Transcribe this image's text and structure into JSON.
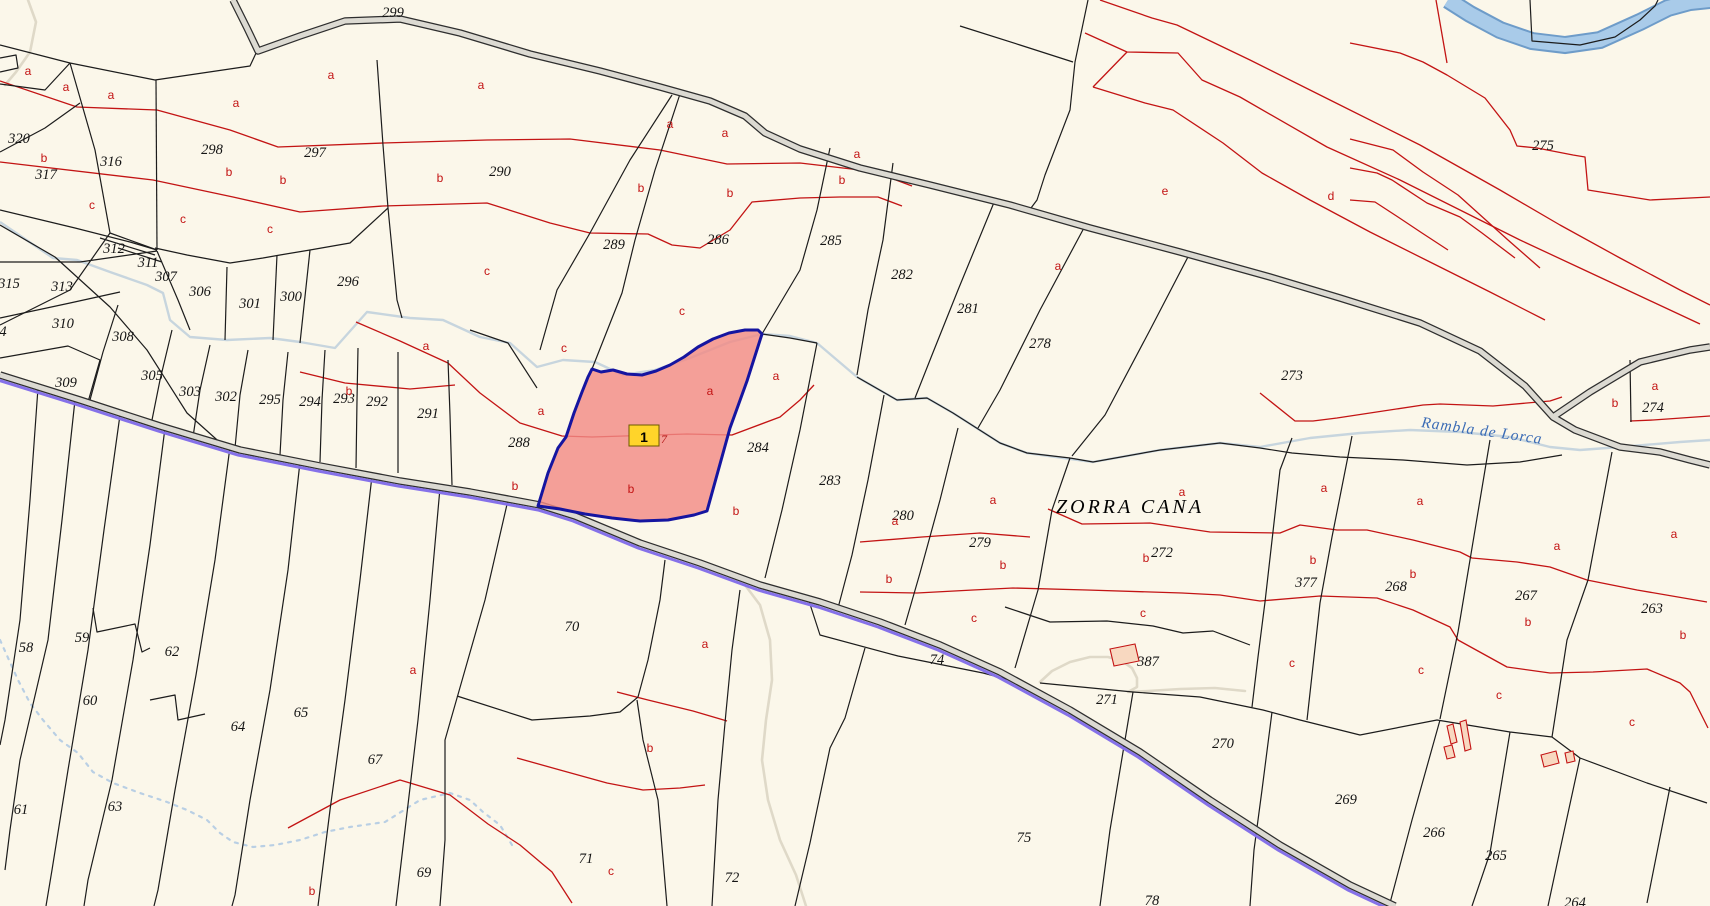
{
  "map": {
    "title": "cadastral-parcel-map",
    "place_names": [
      {
        "text": "ZORRA CANA",
        "x": 1130,
        "y": 507
      }
    ],
    "water_labels": [
      {
        "text": "Rambla de Lorca",
        "x": 1482,
        "y": 431,
        "angle": 8
      }
    ],
    "highlight": {
      "marker_label": "1",
      "sub_label": "7",
      "x": 644,
      "y": 436
    },
    "parcel_numbers": [
      {
        "n": "299",
        "x": 393,
        "y": 13
      },
      {
        "n": "320",
        "x": 19,
        "y": 139
      },
      {
        "n": "317",
        "x": 46,
        "y": 175
      },
      {
        "n": "316",
        "x": 111,
        "y": 162
      },
      {
        "n": "298",
        "x": 212,
        "y": 150
      },
      {
        "n": "297",
        "x": 315,
        "y": 153
      },
      {
        "n": "290",
        "x": 500,
        "y": 172
      },
      {
        "n": "289",
        "x": 614,
        "y": 245
      },
      {
        "n": "286",
        "x": 718,
        "y": 240
      },
      {
        "n": "285",
        "x": 831,
        "y": 241
      },
      {
        "n": "282",
        "x": 902,
        "y": 275
      },
      {
        "n": "281",
        "x": 968,
        "y": 309
      },
      {
        "n": "278",
        "x": 1040,
        "y": 344
      },
      {
        "n": "275",
        "x": 1543,
        "y": 146
      },
      {
        "n": "273",
        "x": 1292,
        "y": 376
      },
      {
        "n": "274",
        "x": 1653,
        "y": 408
      },
      {
        "n": "312",
        "x": 114,
        "y": 249
      },
      {
        "n": "311",
        "x": 148,
        "y": 263
      },
      {
        "n": "307",
        "x": 166,
        "y": 277
      },
      {
        "n": "315",
        "x": 9,
        "y": 284
      },
      {
        "n": "313",
        "x": 62,
        "y": 287
      },
      {
        "n": "306",
        "x": 200,
        "y": 292
      },
      {
        "n": "301",
        "x": 250,
        "y": 304
      },
      {
        "n": "300",
        "x": 291,
        "y": 297
      },
      {
        "n": "296",
        "x": 348,
        "y": 282
      },
      {
        "n": "310",
        "x": 63,
        "y": 324
      },
      {
        "n": "4",
        "x": 3,
        "y": 332
      },
      {
        "n": "308",
        "x": 123,
        "y": 337
      },
      {
        "n": "305",
        "x": 152,
        "y": 376
      },
      {
        "n": "309",
        "x": 66,
        "y": 383
      },
      {
        "n": "303",
        "x": 190,
        "y": 392
      },
      {
        "n": "302",
        "x": 226,
        "y": 397
      },
      {
        "n": "295",
        "x": 270,
        "y": 400
      },
      {
        "n": "294",
        "x": 310,
        "y": 402
      },
      {
        "n": "293",
        "x": 344,
        "y": 399
      },
      {
        "n": "292",
        "x": 377,
        "y": 402
      },
      {
        "n": "291",
        "x": 428,
        "y": 414
      },
      {
        "n": "288",
        "x": 519,
        "y": 443
      },
      {
        "n": "284",
        "x": 758,
        "y": 448
      },
      {
        "n": "283",
        "x": 830,
        "y": 481
      },
      {
        "n": "280",
        "x": 903,
        "y": 516
      },
      {
        "n": "279",
        "x": 980,
        "y": 543
      },
      {
        "n": "272",
        "x": 1162,
        "y": 553
      },
      {
        "n": "377",
        "x": 1306,
        "y": 583
      },
      {
        "n": "268",
        "x": 1396,
        "y": 587
      },
      {
        "n": "267",
        "x": 1526,
        "y": 596
      },
      {
        "n": "263",
        "x": 1652,
        "y": 609
      },
      {
        "n": "387",
        "x": 1148,
        "y": 662
      },
      {
        "n": "74",
        "x": 937,
        "y": 660
      },
      {
        "n": "271",
        "x": 1107,
        "y": 700
      },
      {
        "n": "270",
        "x": 1223,
        "y": 744
      },
      {
        "n": "269",
        "x": 1346,
        "y": 800
      },
      {
        "n": "266",
        "x": 1434,
        "y": 833
      },
      {
        "n": "265",
        "x": 1496,
        "y": 856
      },
      {
        "n": "264",
        "x": 1575,
        "y": 903
      },
      {
        "n": "58",
        "x": 26,
        "y": 648
      },
      {
        "n": "59",
        "x": 82,
        "y": 638
      },
      {
        "n": "62",
        "x": 172,
        "y": 652
      },
      {
        "n": "60",
        "x": 90,
        "y": 701
      },
      {
        "n": "61",
        "x": 21,
        "y": 810
      },
      {
        "n": "63",
        "x": 115,
        "y": 807
      },
      {
        "n": "64",
        "x": 238,
        "y": 727
      },
      {
        "n": "65",
        "x": 301,
        "y": 713
      },
      {
        "n": "67",
        "x": 375,
        "y": 760
      },
      {
        "n": "69",
        "x": 424,
        "y": 873
      },
      {
        "n": "70",
        "x": 572,
        "y": 627
      },
      {
        "n": "71",
        "x": 586,
        "y": 859
      },
      {
        "n": "72",
        "x": 732,
        "y": 878
      },
      {
        "n": "75",
        "x": 1024,
        "y": 838
      },
      {
        "n": "78",
        "x": 1152,
        "y": 901
      }
    ],
    "subparcel_letters": [
      {
        "t": "a",
        "x": 28,
        "y": 71
      },
      {
        "t": "a",
        "x": 66,
        "y": 87
      },
      {
        "t": "a",
        "x": 111,
        "y": 95
      },
      {
        "t": "a",
        "x": 236,
        "y": 103
      },
      {
        "t": "a",
        "x": 331,
        "y": 75
      },
      {
        "t": "a",
        "x": 481,
        "y": 85
      },
      {
        "t": "a",
        "x": 670,
        "y": 124
      },
      {
        "t": "a",
        "x": 725,
        "y": 133
      },
      {
        "t": "a",
        "x": 857,
        "y": 154
      },
      {
        "t": "b",
        "x": 44,
        "y": 158
      },
      {
        "t": "b",
        "x": 229,
        "y": 172
      },
      {
        "t": "b",
        "x": 283,
        "y": 180
      },
      {
        "t": "b",
        "x": 440,
        "y": 178
      },
      {
        "t": "b",
        "x": 641,
        "y": 188
      },
      {
        "t": "b",
        "x": 730,
        "y": 193
      },
      {
        "t": "b",
        "x": 842,
        "y": 180
      },
      {
        "t": "c",
        "x": 92,
        "y": 205
      },
      {
        "t": "c",
        "x": 183,
        "y": 219
      },
      {
        "t": "c",
        "x": 270,
        "y": 229
      },
      {
        "t": "c",
        "x": 487,
        "y": 271
      },
      {
        "t": "c",
        "x": 682,
        "y": 311
      },
      {
        "t": "e",
        "x": 1165,
        "y": 191
      },
      {
        "t": "d",
        "x": 1331,
        "y": 196
      },
      {
        "t": "a",
        "x": 1058,
        "y": 266
      },
      {
        "t": "b",
        "x": 349,
        "y": 391
      },
      {
        "t": "a",
        "x": 426,
        "y": 346
      },
      {
        "t": "a",
        "x": 541,
        "y": 411
      },
      {
        "t": "a",
        "x": 710,
        "y": 391
      },
      {
        "t": "a",
        "x": 776,
        "y": 376
      },
      {
        "t": "b",
        "x": 515,
        "y": 486
      },
      {
        "t": "b",
        "x": 631,
        "y": 489
      },
      {
        "t": "b",
        "x": 736,
        "y": 511
      },
      {
        "t": "c",
        "x": 564,
        "y": 348
      },
      {
        "t": "a",
        "x": 993,
        "y": 500
      },
      {
        "t": "a",
        "x": 1182,
        "y": 492
      },
      {
        "t": "a",
        "x": 895,
        "y": 521
      },
      {
        "t": "b",
        "x": 1003,
        "y": 565
      },
      {
        "t": "b",
        "x": 889,
        "y": 579
      },
      {
        "t": "b",
        "x": 1146,
        "y": 558
      },
      {
        "t": "c",
        "x": 974,
        "y": 618
      },
      {
        "t": "c",
        "x": 1143,
        "y": 613
      },
      {
        "t": "a",
        "x": 1324,
        "y": 488
      },
      {
        "t": "a",
        "x": 1420,
        "y": 501
      },
      {
        "t": "b",
        "x": 1313,
        "y": 560
      },
      {
        "t": "b",
        "x": 1413,
        "y": 574
      },
      {
        "t": "b",
        "x": 1528,
        "y": 622
      },
      {
        "t": "c",
        "x": 1292,
        "y": 663
      },
      {
        "t": "a",
        "x": 1557,
        "y": 546
      },
      {
        "t": "a",
        "x": 1674,
        "y": 534
      },
      {
        "t": "b",
        "x": 1683,
        "y": 635
      },
      {
        "t": "a",
        "x": 1655,
        "y": 386
      },
      {
        "t": "b",
        "x": 1615,
        "y": 403
      },
      {
        "t": "c",
        "x": 1421,
        "y": 670
      },
      {
        "t": "c",
        "x": 1499,
        "y": 695
      },
      {
        "t": "c",
        "x": 1632,
        "y": 722
      },
      {
        "t": "a",
        "x": 413,
        "y": 670
      },
      {
        "t": "a",
        "x": 705,
        "y": 644
      },
      {
        "t": "b",
        "x": 650,
        "y": 748
      },
      {
        "t": "c",
        "x": 611,
        "y": 871
      },
      {
        "t": "b",
        "x": 312,
        "y": 891
      }
    ],
    "colors": {
      "background": "#FBF7EA",
      "boundary": "#1C1C1C",
      "subparcel": "#C31414",
      "road_fill": "#DCDAD2",
      "road_casing": "#2E2E2E",
      "admin_purple": "#8571E9",
      "water": "#A9CBE9",
      "water_edge": "#6E9CC9",
      "stream": "#C7D5DE",
      "path": "#DFD9C8",
      "highlight_fill": "#F28B86",
      "highlight_border": "#1515A0",
      "marker_fill": "#FFD42A",
      "marker_border": "#6B5A00",
      "building_fill": "#F8D8C0"
    },
    "geometry": {
      "roads": [
        "233,0 247,28 258,51 300,36 345,21 400,19 460,33 530,54 600,71 660,87 710,101 745,116 765,133 800,149 860,168 930,185 1010,205 1090,228 1180,252 1270,277 1340,298 1420,323 1480,351 1525,386 1553,417 1590,392 1640,362 1690,350 1710,347",
        "1553,417 1575,430 1620,447 1660,452 1690,460 1710,465",
        "0,375 80,400 160,426 240,450 320,466 400,481 470,492 540,505 575,516 640,543 700,563 760,585 820,602 880,622 940,645 1000,672 1070,710 1140,752 1210,800 1280,845 1350,885 1395,906"
      ],
      "purple_road_index": 2,
      "black_lines": [
        "0,45 70,63 155,80 250,66 257,51",
        "0,84 45,90 70,63",
        "70,63 95,150 110,233",
        "0,152 45,128 80,103",
        "110,233 70,290 0,325",
        "156,80 157,250",
        "110,233 157,250",
        "0,210 75,228 130,242 157,250",
        "0,262 80,262 157,251",
        "100,238 155,255",
        "118,248 162,262",
        "157,251 178,300 190,330",
        "227,267 225,340",
        "155,248 187,255 230,263 263,258 280,255 310,250 350,243 388,208",
        "277,255 273,340",
        "310,250 300,343",
        "377,60 383,145 388,208",
        "388,208 397,300 402,318",
        "0,318 70,303 120,292",
        "0,358 68,346 100,360 88,402",
        "0,225 55,257 110,307 147,350 187,413 225,447",
        "118,305 103,352 90,400",
        "172,330 160,380 152,420",
        "210,345 200,390 193,437",
        "248,350 240,395 235,448",
        "288,352 283,400 280,455",
        "325,350 322,400 320,462",
        "358,348 357,400 356,468",
        "398,352 398,410 398,473",
        "448,360 450,415 452,485",
        "470,330 508,343 537,388",
        "672,95 630,160 590,233 557,290 540,350",
        "680,94 655,170 635,240 622,293 592,369",
        "830,148 817,210 800,270 762,334",
        "893,163 883,240 868,310 857,375",
        "995,200 958,290 932,355 915,398",
        "1085,226 1040,310 1000,390 978,428",
        "1190,253 1150,330 1105,415 1072,456",
        "817,343 800,430 782,510 765,578",
        "884,395 868,480 852,555 838,608",
        "958,428 940,500 920,573 905,625",
        "1070,458 1052,510 1038,590 1015,668",
        "1292,438 1280,470 1265,602 1258,657 1252,707",
        "1352,436 1332,537 1320,603 1307,720",
        "1490,440 1470,560 1458,632 1440,719",
        "1612,452 1588,580 1567,640 1552,737",
        "762,334 790,338 817,343",
        "857,377 897,400 927,398 953,413 1000,443 1027,453 1070,458",
        "1070,458 1093,462 1160,450 1220,443 1260,448 1292,453 1340,457 1403,460 1467,465 1520,462 1562,455",
        "1630,360 1631,422",
        "1040,683 1133,692 1200,697 1263,710 1300,720 1360,735 1437,720 1510,732 1552,737 1580,758 1647,783 1707,803",
        "1133,692 1125,740 1110,830 1100,906",
        "1272,712 1262,790 1254,850 1250,906",
        "1440,720 1412,820 1390,903",
        "1510,732 1490,853 1472,906",
        "1580,758 1560,850 1548,906",
        "1670,787 1647,903",
        "1005,607 1020,612 1050,622 1107,621 1153,626 1183,633 1213,631 1250,645",
        "808,598 820,635 898,656 983,673 1010,680",
        "665,560 660,600 648,660 638,697",
        "457,696 532,720 590,716 620,712 638,697",
        "508,500 485,600 465,670 445,740 445,840 440,906",
        "637,700 643,740 658,800 667,906",
        "740,590 732,650 726,712 718,800 712,906",
        "865,648 845,718 830,748 810,843 795,906",
        "38,388 30,500 20,620 5,720 0,745",
        "75,400 62,520 48,640 20,760 10,830 5,870",
        "120,415 104,530 88,650 68,770 52,870 46,906",
        "165,428 150,545 133,660 112,780 88,880 84,906",
        "230,447 215,560 196,675 175,790 158,890 154,906",
        "300,462 288,570 270,690 250,800 235,895 232,906",
        "372,476 360,580 345,700 330,810 318,906",
        "440,488 430,600 418,720 405,830 396,906",
        "93,608 97,632 135,624 142,652 150,648",
        "150,700 175,695 178,720 205,714",
        "1088,0 1075,62 1070,110 1045,175 1037,200 1028,212",
        "960,26 1020,45 1073,62",
        "1530,0 1532,41 1580,45 1615,37 1640,20 1655,6 1658,0",
        "0,58 16,55 18,68 0,72"
      ],
      "red_lines": [
        "0,81 77,107 157,110 230,130 278,147 383,143 487,140 570,139 660,150 727,164 800,163 860,170 888,177 912,186",
        "0,162 153,180 233,197 300,212 383,206 487,203 550,223 590,233 648,234 672,245 700,248 730,230 752,202 800,198 840,197 878,197 902,206",
        "356,322 400,341 448,363 480,393 520,423 562,436 592,437 687,434 732,435 780,417 800,400 814,385",
        "300,372 345,383 410,389 455,385",
        "860,542 922,537 980,533 1030,537",
        "1048,509 1082,524 1150,523 1210,532 1280,533 1300,525 1337,530 1367,530 1413,540 1460,552 1472,558 1517,562 1550,567 1587,580 1637,590 1707,602",
        "860,592 917,593 973,590 1013,588 1087,590 1182,593 1220,595 1260,601 1320,596 1377,598 1413,610 1450,627 1458,640 1507,667 1550,673 1593,672 1647,669 1680,683 1690,692 1708,728",
        "288,828 340,800 400,780 450,795 488,824 520,845 552,872 572,903",
        "617,692 648,700 693,711 727,721",
        "517,758 560,770 607,783 643,790 680,788 705,785",
        "1260,393 1295,421 1313,421 1337,418 1423,405 1440,404 1493,406 1550,401 1562,397",
        "1630,421 1653,420 1710,416",
        "1085,33 1127,52 1178,53 1202,80 1240,97 1327,147 1400,180 1460,210 1520,240 1580,268 1640,296 1700,324",
        "1100,0 1152,18 1177,25 1250,60 1330,100 1420,145 1500,190 1560,225 1620,258 1680,290 1710,305",
        "1093,87 1145,103 1173,110 1223,143 1262,173 1310,200 1370,232 1430,262 1490,292 1545,320",
        "1093,87 1127,52",
        "1350,139 1393,150 1423,172 1458,195 1508,240 1540,268",
        "1350,168 1377,173 1392,180 1427,203 1460,217 1482,233 1515,258",
        "1350,200 1375,202 1398,217 1422,233 1448,250",
        "1350,43 1400,53 1423,62 1447,75 1485,98 1510,130 1517,146 1537,148 1573,155 1585,157 1588,190 1650,200 1710,197",
        "1436,0 1447,63"
      ],
      "streams_solid": [
        "0,222 53,258 77,260 110,272 147,285 163,293 170,320 190,337 227,340 270,338 300,342 335,348 367,312 410,318 443,320 480,337 510,343 537,367 563,360 595,362 623,375 655,370 690,358 730,342 762,334 790,336 817,343 857,377 897,400 927,398 953,413 1000,443 1027,453 1093,462 1160,450 1220,443 1260,447 1310,438 1360,433 1410,430 1460,432 1510,437 1550,447 1580,450 1620,447 1680,442 1710,440"
      ],
      "streams_dotted": [
        "0,640 18,680 30,703 43,720 60,740 78,753 93,772 113,783 140,793 167,802 187,810 207,820 220,833 233,842 253,847 275,845 300,840 325,832 350,827 385,822 420,800 450,793 470,800 483,812 500,825 512,845"
      ],
      "paths": [
        "28,0 36,22 30,52 16,72 5,85",
        "745,585 760,605 770,640 772,680 766,720 762,760 768,800 780,840 796,875 806,906",
        "1040,682 1052,671 1070,662 1090,657 1108,657 1122,661 1132,668 1137,678 1137,687 1128,692 1148,691 1180,689 1215,688 1245,691"
      ],
      "river": "1448,0 1470,14 1500,30 1532,41 1565,45 1600,40 1640,22 1668,8 1690,2 1710,0",
      "highlight_polygon": "592,369 601,372 613,370 627,374 642,375 656,371 670,365 684,357 698,347 713,339 729,333 745,330 758,330 762,334 747,381 730,428 707,511 694,515 668,520 640,521 612,518 585,514 560,509 538,506 548,473 558,448 566,437 574,413 582,392 588,377",
      "buildings": [
        "1110,649 1135,644 1139,661 1114,666",
        "1447,726 1453,724 1457,742 1451,744",
        "1460,722 1466,720 1471,749 1465,751",
        "1444,747 1452,745 1455,757 1447,759",
        "1541,755 1556,751 1559,763 1544,767",
        "1565,753 1573,751 1575,761 1567,763"
      ]
    }
  }
}
